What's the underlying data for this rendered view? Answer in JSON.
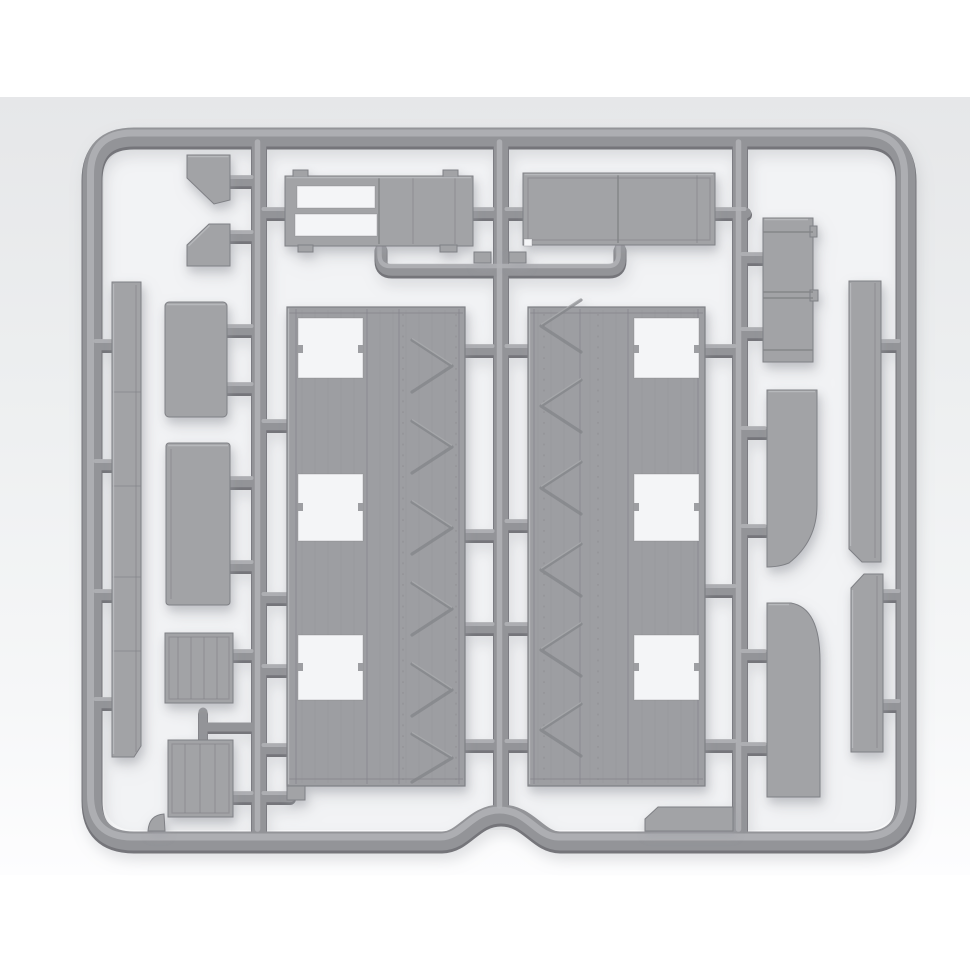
{
  "scene": {
    "kind": "product-photo",
    "subject": "unassembled plastic model kit sprue (injection-molded runner) with unpainted parts",
    "plastic_color_name": "light gray",
    "orientation": "rectangular sprue frame, three internal vertical runners, parts attached by short gates"
  },
  "colors": {
    "page_bg": "#ffffff",
    "photo_bg_top": "#e6e7e9",
    "photo_bg_mid": "#edeff0",
    "photo_bg_low": "#f6f7f8",
    "photo_bg_bottom": "#fdfdfe",
    "inside_bg": "#f2f3f5",
    "tube_dark": "#74757a",
    "tube_main": "#939498",
    "tube_highlight": "#b2b3b6",
    "part_fill": "#a2a3a6",
    "panel_fill": "#9d9ea2",
    "part_edge": "#7f8085",
    "part_highlight": "#bcbdc0",
    "detail_line": "#838488",
    "cutout": "#f4f5f7",
    "shadow": "#9fa2a8"
  },
  "sprue": {
    "frame": {
      "name": "sprue outer frame",
      "corner_style": "rounded, with raised dome notch at bottom center"
    },
    "runners": [
      {
        "name": "left vertical runner"
      },
      {
        "name": "center vertical runner"
      },
      {
        "name": "right vertical runner"
      },
      {
        "name": "u-shaped bridge runner below top parts"
      },
      {
        "name": "feed gate to lower crate"
      },
      {
        "name": "short attachment gates (stubs)"
      }
    ],
    "parts": [
      {
        "name": "left outer sill strip",
        "description": "long narrow slab along left frame with segment joints"
      },
      {
        "name": "upper wedge block",
        "description": "small angled wedge part, top left"
      },
      {
        "name": "lower wedge block",
        "description": "small angled wedge part, mirrored"
      },
      {
        "name": "small blank panel",
        "description": "rounded rectangular panel, left column"
      },
      {
        "name": "door panel",
        "description": "tall blank panel, left column"
      },
      {
        "name": "small slatted crate",
        "description": "crate face with vertical slats"
      },
      {
        "name": "large slatted crate",
        "description": "crate face with vertical slats, lower left"
      },
      {
        "name": "slotted flatbed frame",
        "description": "rectangular frame part with two open slots and paneled half"
      },
      {
        "name": "roof / floor panel",
        "description": "long paneled rectangle with seam lines"
      },
      {
        "name": "wagon side panel left",
        "description": "large wall panel, three window openings, diagonal chevron braces"
      },
      {
        "name": "wagon side panel right",
        "description": "mirrored large wall panel, three window openings, chevron braces"
      },
      {
        "name": "stacked box part",
        "description": "tall banded rectangular part, upper right"
      },
      {
        "name": "curved fender upper",
        "description": "slab with curved lower-right cutaway"
      },
      {
        "name": "curved fender lower",
        "description": "slab with curved upper-right cutaway"
      },
      {
        "name": "right sill strip upper",
        "description": "narrow strip along right frame"
      },
      {
        "name": "right sill strip lower",
        "description": "narrow strip along right frame"
      },
      {
        "name": "step plate",
        "description": "small plate seated on bottom runner"
      },
      {
        "name": "corner nub",
        "description": "small molding nub on bottom runner"
      },
      {
        "name": "gate tab left",
        "description": "small tab on bridge runner"
      },
      {
        "name": "gate tab right",
        "description": "small tab on bridge runner"
      }
    ],
    "window_openings_per_side_panel": 3,
    "chevron_braces_per_side_panel": 6
  }
}
